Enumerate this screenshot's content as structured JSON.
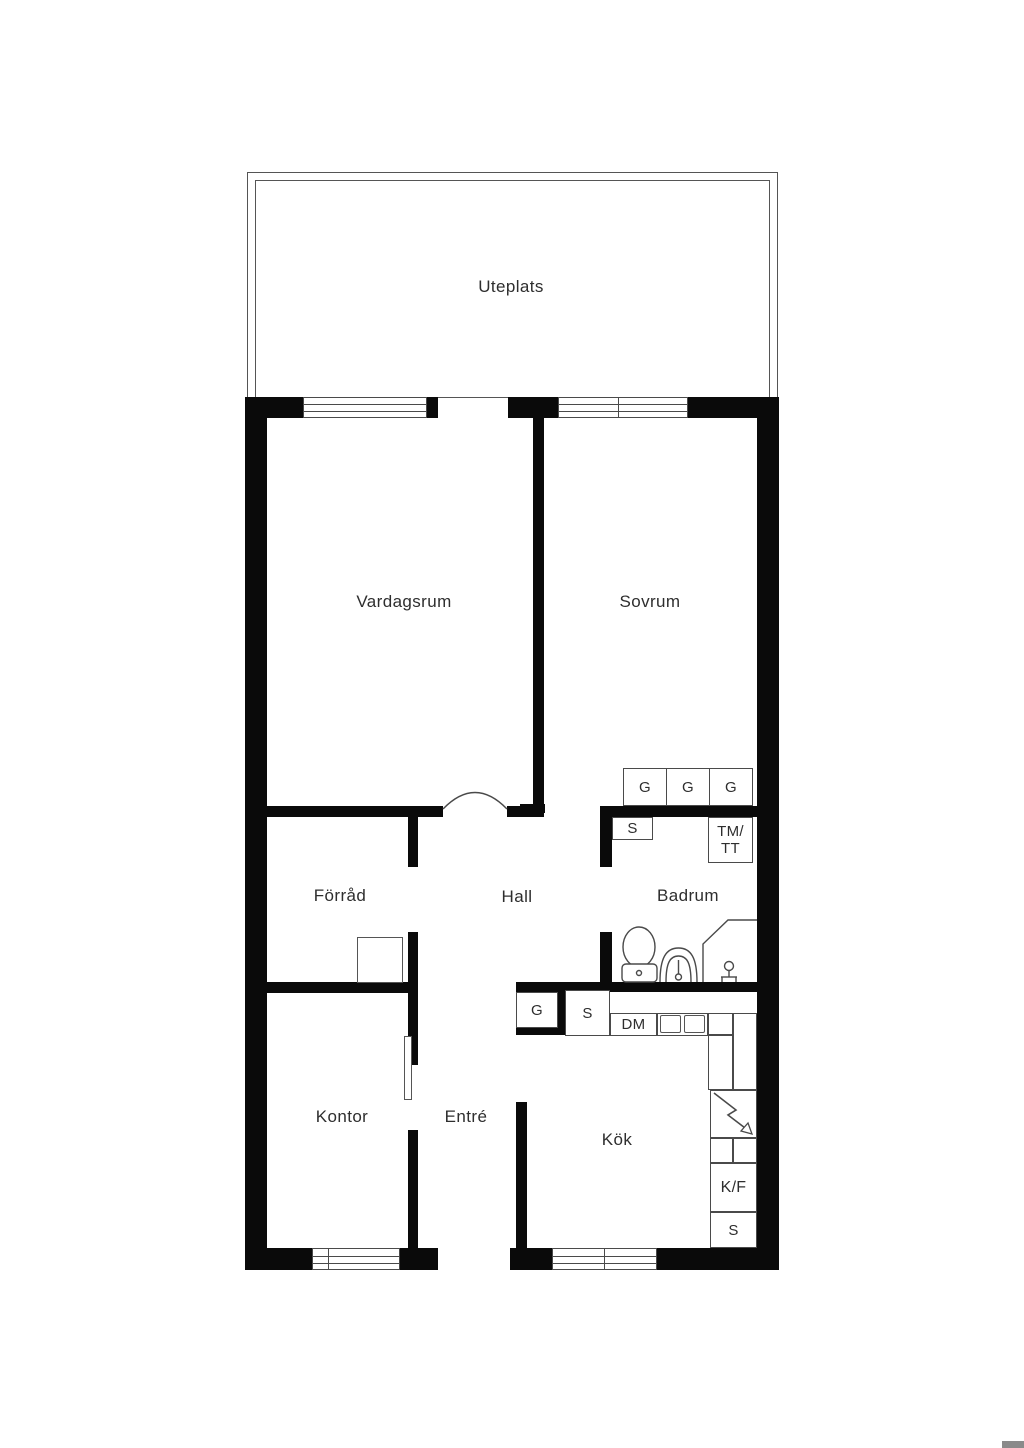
{
  "plan_title": "Apartment floor plan",
  "rooms": {
    "uteplats": "Uteplats",
    "vardagsrum": "Vardagsrum",
    "sovrum": "Sovrum",
    "forrad": "Förråd",
    "hall": "Hall",
    "badrum": "Badrum",
    "kontor": "Kontor",
    "entre": "Entré",
    "kok": "Kök"
  },
  "fixtures": {
    "wardrobe_1": "G",
    "wardrobe_2": "G",
    "wardrobe_3": "G",
    "closet_sovrum": "S",
    "washer_dryer_line1": "TM/",
    "washer_dryer_line2": "TT",
    "wardrobe_hall": "G",
    "closet_hall": "S",
    "dishwasher": "DM",
    "fridge_freezer": "K/F",
    "pantry_kok": "S"
  },
  "colors": {
    "wall": "#0a0a0a",
    "thin_line": "#4a4a4a",
    "text": "#2e2e2e",
    "background": "#ffffff",
    "watermark": "#8a8a8a"
  }
}
